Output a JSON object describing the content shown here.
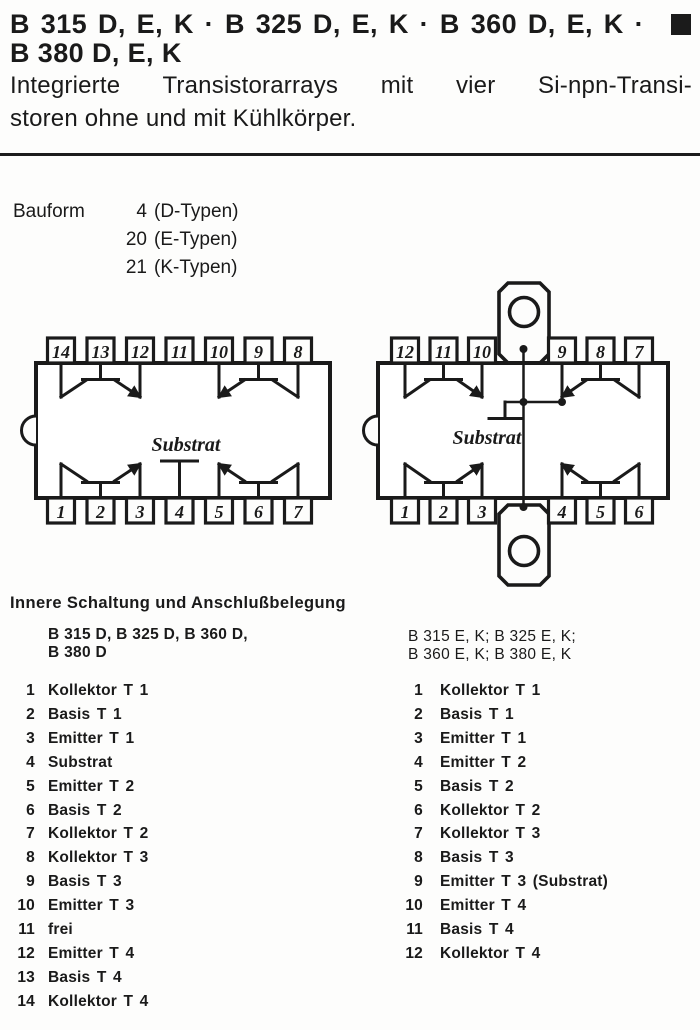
{
  "colors": {
    "ink": "#1a1a1a",
    "paper": "#fdfdfc"
  },
  "header": {
    "title_line1": "B 315 D, E, K · B 325 D, E, K · B 360 D, E, K ·",
    "title_line2": "B 380 D, E, K",
    "subtitle_line1": "Integrierte Transistorarrays mit vier Si-npn-Transi-",
    "subtitle_line2": "storen ohne und mit Kühlkörper."
  },
  "bauform": {
    "label": "Bauform",
    "entries": [
      {
        "number": "4",
        "text": "(D-Typen)"
      },
      {
        "number": "20",
        "text": "(E-Typen)"
      },
      {
        "number": "21",
        "text": "(K-Typen)"
      }
    ]
  },
  "diagrams": {
    "left_package": {
      "top_pins": [
        "14",
        "13",
        "12",
        "11",
        "10",
        "9",
        "8"
      ],
      "bottom_pins": [
        "1",
        "2",
        "3",
        "4",
        "5",
        "6",
        "7"
      ],
      "substrate_label": "Substrat"
    },
    "right_package": {
      "top_pins": [
        "12",
        "11",
        "10",
        "9",
        "8",
        "7"
      ],
      "bottom_pins": [
        "1",
        "2",
        "3",
        "4",
        "5",
        "6"
      ],
      "substrate_label": "Substrat"
    }
  },
  "pinout": {
    "heading": "Innere Schaltung und Anschlußbelegung",
    "left": {
      "header_line1": "B 315 D, B 325 D, B 360 D,",
      "header_line2": "B 380 D",
      "pins": [
        {
          "number": "1",
          "label": "Kollektor T 1"
        },
        {
          "number": "2",
          "label": "Basis T 1"
        },
        {
          "number": "3",
          "label": "Emitter T 1"
        },
        {
          "number": "4",
          "label": "Substrat"
        },
        {
          "number": "5",
          "label": "Emitter T 2"
        },
        {
          "number": "6",
          "label": "Basis T 2"
        },
        {
          "number": "7",
          "label": "Kollektor T 2"
        },
        {
          "number": "8",
          "label": "Kollektor T 3"
        },
        {
          "number": "9",
          "label": "Basis T 3"
        },
        {
          "number": "10",
          "label": "Emitter T 3"
        },
        {
          "number": "11",
          "label": "frei"
        },
        {
          "number": "12",
          "label": "Emitter T 4"
        },
        {
          "number": "13",
          "label": "Basis T 4"
        },
        {
          "number": "14",
          "label": "Kollektor T 4"
        }
      ]
    },
    "right": {
      "header_line1": "B 315 E, K; B 325 E, K;",
      "header_line2": "B 360 E, K; B 380 E, K",
      "pins": [
        {
          "number": "1",
          "label": "Kollektor T 1"
        },
        {
          "number": "2",
          "label": "Basis T 1"
        },
        {
          "number": "3",
          "label": "Emitter T 1"
        },
        {
          "number": "4",
          "label": "Emitter T 2"
        },
        {
          "number": "5",
          "label": "Basis T 2"
        },
        {
          "number": "6",
          "label": "Kollektor T 2"
        },
        {
          "number": "7",
          "label": "Kollektor T 3"
        },
        {
          "number": "8",
          "label": "Basis T 3"
        },
        {
          "number": "9",
          "label": "Emitter T 3 (Substrat)"
        },
        {
          "number": "10",
          "label": "Emitter T 4"
        },
        {
          "number": "11",
          "label": "Basis T 4"
        },
        {
          "number": "12",
          "label": "Kollektor T 4"
        }
      ]
    }
  }
}
